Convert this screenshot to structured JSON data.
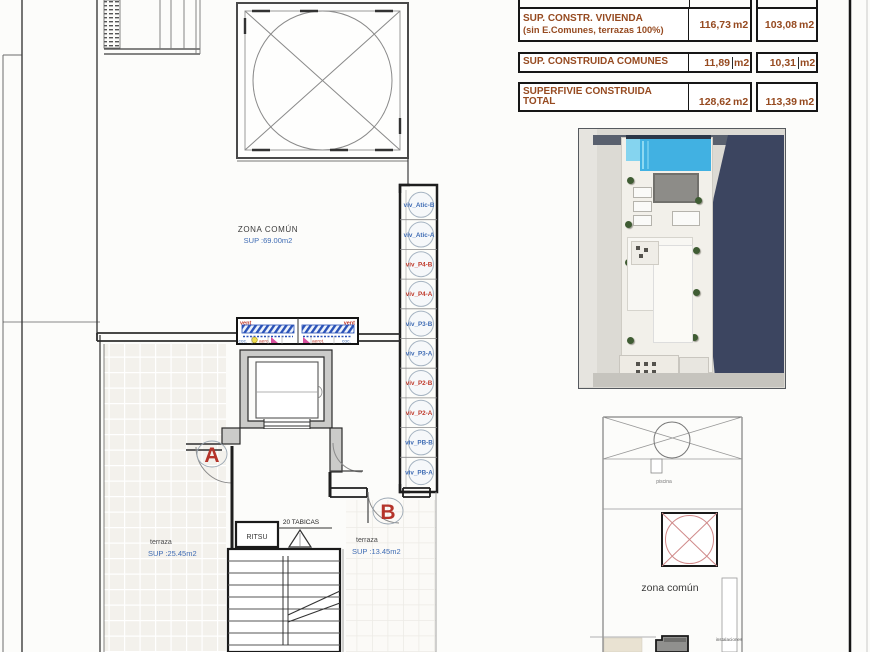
{
  "colors": {
    "accent_blue": "#3f6cb4",
    "accent_red": "#c03a2b",
    "letter_red": "#b5342a",
    "table_brown": "#964a20",
    "line_dark": "#2e2e2e",
    "line_mid": "#8a8a8a"
  },
  "table": {
    "rows": [
      {
        "line1": "SUP. CONSTR. VIVIENDA",
        "line2": "(sin E.Comunes, terrazas 100%)",
        "v1": "116,73",
        "u1": "m2",
        "v2": "103,08",
        "u2": "m2"
      },
      {
        "line1": "SUP. CONSTRUIDA COMUNES",
        "line2": "",
        "v1": "11,89",
        "u1": "m2",
        "v2": "10,31",
        "u2": "m2"
      },
      {
        "line1": "SUPERFIVIE CONSTRUIDA",
        "line2": "TOTAL",
        "v1": "128,62",
        "u1": "m2",
        "v2": "113,39",
        "u2": "m2"
      }
    ]
  },
  "plan": {
    "zona_comun": "ZONA COMÚN",
    "zona_comun_sup": "SUP :69.00m2",
    "terraza_left": "terraza",
    "terraza_left_sup": "SUP :25.45m2",
    "terraza_right": "terraza",
    "terraza_right_sup": "SUP :13.45m2",
    "door_a": "A",
    "door_b": "B",
    "ritsu": "RITSU",
    "tabicas": "20 TABICAS",
    "vent_left": "vent",
    "vent_right": "vent",
    "coc_left": "coc.",
    "aero_left": "aero.",
    "aero_right": "aerot.",
    "coc_right": "coc."
  },
  "viv_units": [
    {
      "label": "viv_Atic-B",
      "color": "#3f6cb4"
    },
    {
      "label": "viv_Atic-A",
      "color": "#3f6cb4"
    },
    {
      "label": "viv_P4-B",
      "color": "#c03a2b"
    },
    {
      "label": "viv_P4-A",
      "color": "#c03a2b"
    },
    {
      "label": "viv_P3-B",
      "color": "#3f6cb4"
    },
    {
      "label": "viv_P3-A",
      "color": "#3f6cb4"
    },
    {
      "label": "viv_P2-B",
      "color": "#c03a2b"
    },
    {
      "label": "viv_P2-A",
      "color": "#c03a2b"
    },
    {
      "label": "viv_PB-B",
      "color": "#3f6cb4"
    },
    {
      "label": "viv_PB-A",
      "color": "#3f6cb4"
    }
  ],
  "mini_plan": {
    "piscina": "piscina",
    "zona_comun": "zona común",
    "instalaciones": "instalaciones"
  }
}
